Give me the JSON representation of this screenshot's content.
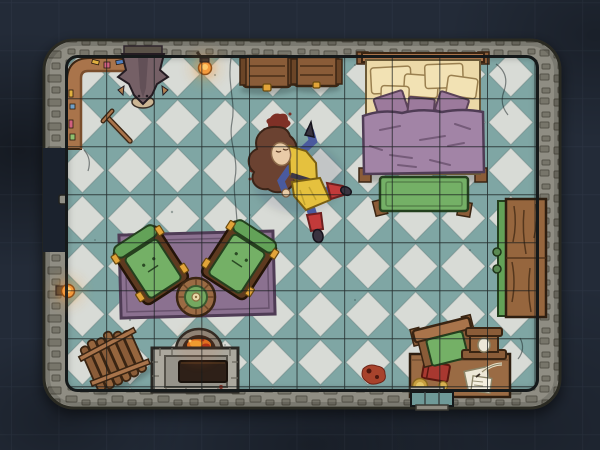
{
  "scene": {
    "name": "Bedroom battle map (top-down, hand-drawn VTT style)",
    "room_shape": "rounded rectangle with stone walls"
  },
  "grid": {
    "cell_w": 47.6,
    "cell_h": 48,
    "offset_x": 11,
    "offset_y": 2.3
  },
  "palette": {
    "bg": "#232B38",
    "bg-dark": "#1B222D",
    "wall": "#8F8D83",
    "wall-stone": "#77756B",
    "wall-line": "#55534A",
    "wall-edge": "#2B2A24",
    "floor-teal": "#7FA6A4",
    "floor-light": "#D8DBD6",
    "grid": "#161B1C",
    "wood": "#8A5C38",
    "wood-dark": "#3A2513",
    "wood-light": "#A9744B",
    "door-wood": "#96663E",
    "desk-wood": "#9A6B44",
    "gold": "#E2A439",
    "stone-light": "#ABA89E",
    "stone-mid": "#96938A",
    "fire-orange": "#E07020",
    "fire-deep": "#B03018",
    "flame": "#F59B3C",
    "rug": "#8B7190",
    "rug-border": "#4F3C55",
    "green": "#74B066",
    "green-mid": "#63A258",
    "green-dark": "#24401E",
    "table-green": "#74A860",
    "bed-sheet": "#ECD9A8",
    "bed-blanket": "#A284A6",
    "pillow": "#9C7A9C",
    "statue-stone": "#756066",
    "hair": "#6B4231",
    "skin": "#E9CBA7",
    "tunic": "#E5C13E",
    "sleeve": "#4A5A9E",
    "boot-red": "#C23A3A",
    "shoe-dark": "#39333F",
    "blood": "#7E3026",
    "book-red": "#A83830",
    "paper": "#EDE8D8"
  },
  "objects": {
    "statue": {
      "label": "stone gargoyle statue on north wall"
    },
    "wall-shelf": {
      "label": "corner wall shelf with trinkets"
    },
    "hanging-lamp": {
      "label": "hanging lamp"
    },
    "wall-torch": {
      "label": "wall torch, west wall"
    },
    "chest-left": {
      "label": "wooden chest"
    },
    "chest-right": {
      "label": "wooden chest"
    },
    "bed": {
      "label": "bed with purple blanket and pillows"
    },
    "bed-bench": {
      "label": "green bench at foot of bed"
    },
    "east-door": {
      "label": "wooden door, east wall"
    },
    "west-door": {
      "label": "door, west wall"
    },
    "rug": {
      "label": "purple rug"
    },
    "armchair-left": {
      "label": "green armchair"
    },
    "armchair-right": {
      "label": "green armchair"
    },
    "round-table": {
      "label": "round wooden table"
    },
    "fireplace": {
      "label": "stone stove with burning fire"
    },
    "firewood": {
      "label": "bundle of firewood"
    },
    "desk": {
      "label": "desk with book, plate, papers and quill"
    },
    "desk-chair": {
      "label": "desk chair, knocked askew"
    },
    "desk-lantern": {
      "label": "small wooden lantern on desk"
    },
    "south-window": {
      "label": "window, south wall"
    },
    "cane": {
      "label": "dropped cane"
    },
    "blood": {
      "label": "blood stains"
    }
  },
  "tokens": {
    "character": {
      "label": "unconscious adventurer",
      "pose": "prone"
    }
  }
}
